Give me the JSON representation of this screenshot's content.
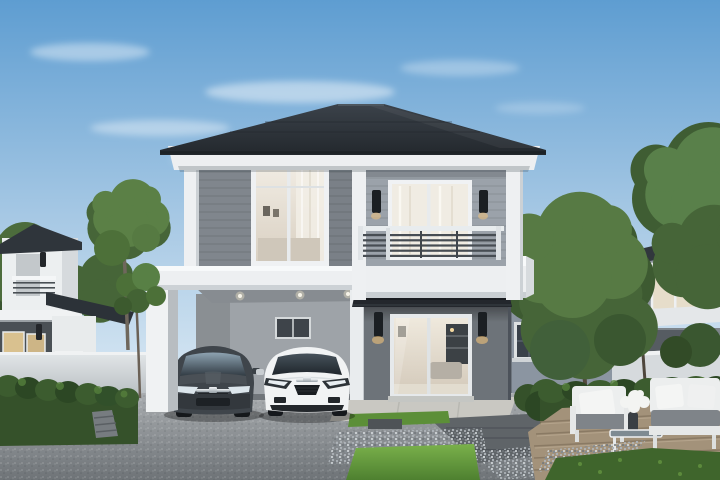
{
  "scene": {
    "type": "3d-architectural-rendering",
    "description": "Daytime exterior rendering of a modern two-story detached house with attached carport holding two cars, balcony, black awning over glass sliding door, landscaped front yard with lawn, gravel borders, paver walkway and wooden deck with outdoor lounge furniture; neighboring two-story houses, white perimeter fences, hedges and green trees under a blue sky",
    "objects": [
      "sky",
      "clouds",
      "main-house",
      "hip-roof",
      "second-floor-siding",
      "bedroom-window",
      "balcony-window",
      "balcony-railing",
      "wall-lamps",
      "carport",
      "carport-downlights",
      "dark-hatchback-car",
      "white-sports-car",
      "black-awning",
      "glass-sliding-door",
      "side-wing",
      "entry-pad",
      "paver-path",
      "lawn",
      "gravel-border",
      "wooden-deck",
      "outdoor-armchair",
      "coffee-table",
      "white-flowers",
      "outdoor-sofa",
      "hedges",
      "white-fence",
      "left-neighbor-house",
      "right-neighbor-house",
      "trees",
      "sapling"
    ],
    "counts": {
      "cars": 2,
      "front_wall_lamps": 4,
      "carport_downlights": 3,
      "seating_pieces": 2
    }
  },
  "palette": {
    "sky_top": "#5e9dd1",
    "sky_horizon": "#e9f2f8",
    "roof_dark": "#2c3238",
    "trim_white": "#edeff1",
    "siding_left": "#8f969e",
    "siding_right": "#9ba2aa",
    "first_floor_wall": "#6d7379",
    "wing_wall": "#8b95a1",
    "carport_wall": "#9ea3a8",
    "awning_black": "#23272c",
    "glass_warm": "#e7e0d4",
    "driveway_gray": "#94999d",
    "concrete_pad": "#c9c8c2",
    "paver_dark": "#5f6468",
    "gravel_light": "#c7ccd1",
    "lawn_green": "#69a23f",
    "grass_dark": "#3f652c",
    "hedge_green": "#35512a",
    "tree_green": "#466538",
    "fence_white": "#d6dadd",
    "deck_wood": "#a3927a",
    "car_dark_body": "#3f454b",
    "car_white_body": "#f1f3f4",
    "cushion_gray": "#7f8489",
    "flower_white": "#f3f4f2",
    "lamp_black": "#1b1f23",
    "lamp_glow": "#f0c27a"
  }
}
